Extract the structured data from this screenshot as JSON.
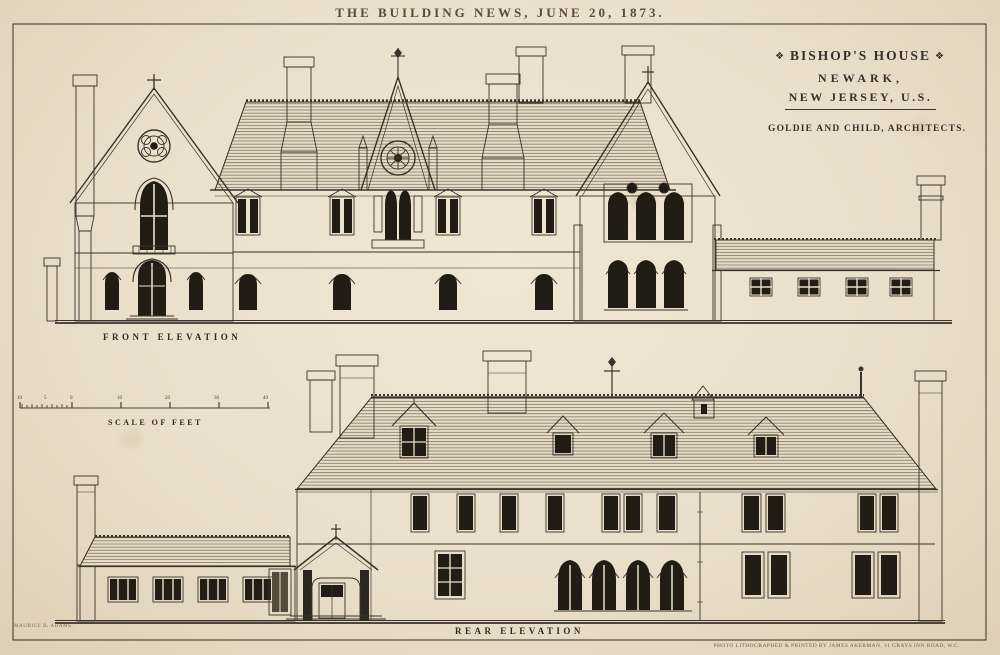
{
  "page": {
    "masthead": "THE BUILDING NEWS, JUNE 20, 1873.",
    "printer_credit": "PHOTO LITHOGRAPHED & PRINTED BY JAMES AKERMAN, 31 GRAYS INN ROAD, W.C.",
    "artist_credit": "MAURICE B. ADAMS."
  },
  "title_block": {
    "ornament_left": "❖",
    "ornament_right": "❖",
    "title": "BISHOP'S HOUSE",
    "city": "NEWARK,",
    "region": "NEW JERSEY, U.S.",
    "architects": "GOLDIE AND CHILD, ARCHITECTS."
  },
  "labels": {
    "front_elevation": "FRONT ELEVATION",
    "rear_elevation": "REAR ELEVATION",
    "scale_of_feet": "SCALE OF FEET"
  },
  "scale_bar": {
    "ticks": [
      "10",
      "5",
      "0",
      "10",
      "20",
      "30",
      "40"
    ]
  },
  "colors": {
    "paper": "#eadfca",
    "ink": "#3a3228",
    "window_dark": "#221c15"
  }
}
